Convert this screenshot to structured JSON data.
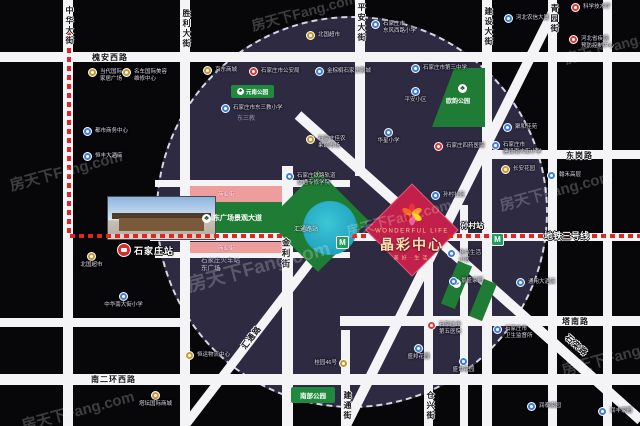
{
  "watermark_text": "房天下Fang.com",
  "colors": {
    "background": "#07070a",
    "circle_fill": "#2e2a42",
    "road": "#f4f3f6",
    "metro_line_red": "#e02525",
    "metro_green": "#1fa05a",
    "park_green": "#1e7c35",
    "commercial_pink": "#ee9d9d",
    "project_magenta": "#c2204a",
    "project_gold": "#ffe3b0"
  },
  "roads": {
    "zhonghua": "中华大街",
    "shengli": "胜利大街",
    "pingan": "平安大街",
    "jianshe": "建设大街",
    "qingyuan": "青园街",
    "huaianxi": "槐安西路",
    "donggang": "东岗路",
    "jinli": "金利街",
    "tanan": "塔南路",
    "nanerhuanxi": "南二环西路",
    "jiantong": "建通街",
    "cangxing": "仓兴街",
    "huitong": "汇通路",
    "shiluan": "石栾路"
  },
  "metro": {
    "line_label": "地铁三号线",
    "stations": [
      {
        "name": "汇通路站"
      },
      {
        "name": "孙村站"
      }
    ]
  },
  "rail_station": {
    "name": "石家庄站"
  },
  "station_area": {
    "commercial_street": "商业街",
    "boulevard": "东广场景观大道",
    "east_square_l1": "石家庄火车站",
    "east_square_l2": "东广场"
  },
  "project": {
    "name_en": "WONDERFUL LIFE",
    "name": "晶彩中心",
    "slogan": "美好·生活"
  },
  "parks": {
    "yuannan": "元南公园",
    "ouyun": "欧韵公园",
    "nanbu": "南部公园"
  },
  "places": {
    "dongsanjiao": "东三教"
  },
  "pois": [
    {
      "x": 88,
      "y": 68,
      "icon": "yellow",
      "lines": [
        "当代国际",
        "家居广场"
      ],
      "pos": "right"
    },
    {
      "x": 122,
      "y": 68,
      "icon": "yellow",
      "lines": [
        "名车国际美容",
        "维修中心"
      ],
      "pos": "right"
    },
    {
      "x": 83,
      "y": 127,
      "icon": "blue",
      "label": "都市商务中心",
      "pos": "right"
    },
    {
      "x": 83,
      "y": 152,
      "icon": "blue",
      "label": "恒丰大酒店",
      "pos": "right"
    },
    {
      "x": 203,
      "y": 66,
      "icon": "yellow",
      "label": "京东商城",
      "pos": "right"
    },
    {
      "x": 249,
      "y": 67,
      "icon": "red",
      "label": "石家庄市公安局",
      "pos": "right"
    },
    {
      "x": 315,
      "y": 67,
      "icon": "blue",
      "label": "金棕榈石家庄影城",
      "pos": "right"
    },
    {
      "x": 306,
      "y": 31,
      "icon": "yellow",
      "label": "北国超市",
      "pos": "right"
    },
    {
      "x": 371,
      "y": 20,
      "icon": "blue",
      "lines": [
        "石家庄市",
        "东风西路小学"
      ],
      "pos": "right"
    },
    {
      "x": 504,
      "y": 14,
      "icon": "blue",
      "label": "河北农信大厦",
      "pos": "right"
    },
    {
      "x": 571,
      "y": 3,
      "icon": "red",
      "label": "科学技术厅",
      "pos": "right"
    },
    {
      "x": 569,
      "y": 35,
      "icon": "red",
      "lines": [
        "河北省疾病",
        "预防控制中心"
      ],
      "pos": "right"
    },
    {
      "x": 221,
      "y": 104,
      "icon": "blue",
      "label": "石家庄市东三教小学",
      "pos": "right"
    },
    {
      "x": 306,
      "y": 135,
      "icon": "yellow",
      "lines": [
        "石家庄佳农",
        "果蔬市场"
      ],
      "pos": "right"
    },
    {
      "x": 384,
      "y": 128,
      "icon": "blue",
      "label": "华星小学",
      "pos": "below"
    },
    {
      "x": 285,
      "y": 172,
      "icon": "blue",
      "lines": [
        "石家庄铁路轨道",
        "交通专修学院"
      ],
      "pos": "right"
    },
    {
      "x": 411,
      "y": 64,
      "icon": "blue",
      "label": "石家庄市第三中学",
      "pos": "right"
    },
    {
      "x": 411,
      "y": 87,
      "icon": "blue",
      "label": "平安小区",
      "pos": "below"
    },
    {
      "x": 434,
      "y": 142,
      "icon": "red",
      "label": "石家庄四药医院",
      "pos": "right"
    },
    {
      "x": 503,
      "y": 123,
      "icon": "blue",
      "label": "聚和佳苑",
      "pos": "right"
    },
    {
      "x": 491,
      "y": 141,
      "icon": "blue",
      "lines": [
        "石家庄市",
        "建设南大街小学"
      ],
      "pos": "right"
    },
    {
      "x": 501,
      "y": 165,
      "icon": "yellow",
      "label": "长安花园",
      "pos": "right"
    },
    {
      "x": 547,
      "y": 171,
      "icon": "blue",
      "label": "翰禾高层",
      "pos": "right"
    },
    {
      "x": 87,
      "y": 252,
      "icon": "yellow",
      "label": "北国超市",
      "pos": "below"
    },
    {
      "x": 119,
      "y": 292,
      "icon": "blue",
      "label": "中华南大街小学",
      "pos": "below"
    },
    {
      "x": 431,
      "y": 191,
      "icon": "blue",
      "label": "孙村社区",
      "pos": "right"
    },
    {
      "x": 447,
      "y": 249,
      "icon": "blue",
      "lines": [
        "仓兴生活",
        "小区"
      ],
      "pos": "right"
    },
    {
      "x": 449,
      "y": 277,
      "icon": "blue",
      "label": "景盛家园",
      "pos": "right"
    },
    {
      "x": 516,
      "y": 278,
      "icon": "blue",
      "label": "通用大酒店",
      "pos": "right"
    },
    {
      "x": 151,
      "y": 391,
      "icon": "yellow",
      "label": "塔坛国际商城",
      "pos": "below"
    },
    {
      "x": 185,
      "y": 351,
      "icon": "yellow",
      "label": "恒运物流中心",
      "pos": "right"
    },
    {
      "x": 339,
      "y": 359,
      "icon": "yellow",
      "label": "桂园46号",
      "pos": "left"
    },
    {
      "x": 427,
      "y": 321,
      "icon": "red",
      "lines": [
        "石家庄市",
        "第五医院"
      ],
      "pos": "right"
    },
    {
      "x": 493,
      "y": 325,
      "icon": "blue",
      "lines": [
        "石家庄市",
        "卫生监督所"
      ],
      "pos": "right"
    },
    {
      "x": 414,
      "y": 344,
      "icon": "blue",
      "label": "盛邦花园",
      "pos": "below"
    },
    {
      "x": 459,
      "y": 357,
      "icon": "blue",
      "label": "盛世花园",
      "pos": "below"
    },
    {
      "x": 527,
      "y": 402,
      "icon": "blue",
      "label": "润泰家园",
      "pos": "right"
    },
    {
      "x": 598,
      "y": 407,
      "icon": "blue",
      "label": "润丰家园",
      "pos": "right"
    }
  ],
  "watermarks": [
    {
      "x": 8,
      "y": 160,
      "s": 15
    },
    {
      "x": 185,
      "y": 252,
      "s": 19
    },
    {
      "x": 250,
      "y": 2,
      "s": 14
    },
    {
      "x": 498,
      "y": 180,
      "s": 15
    },
    {
      "x": 563,
      "y": 35,
      "s": 14
    },
    {
      "x": 560,
      "y": 345,
      "s": 15
    },
    {
      "x": 345,
      "y": 208,
      "s": 14
    },
    {
      "x": 20,
      "y": 400,
      "s": 15
    }
  ]
}
